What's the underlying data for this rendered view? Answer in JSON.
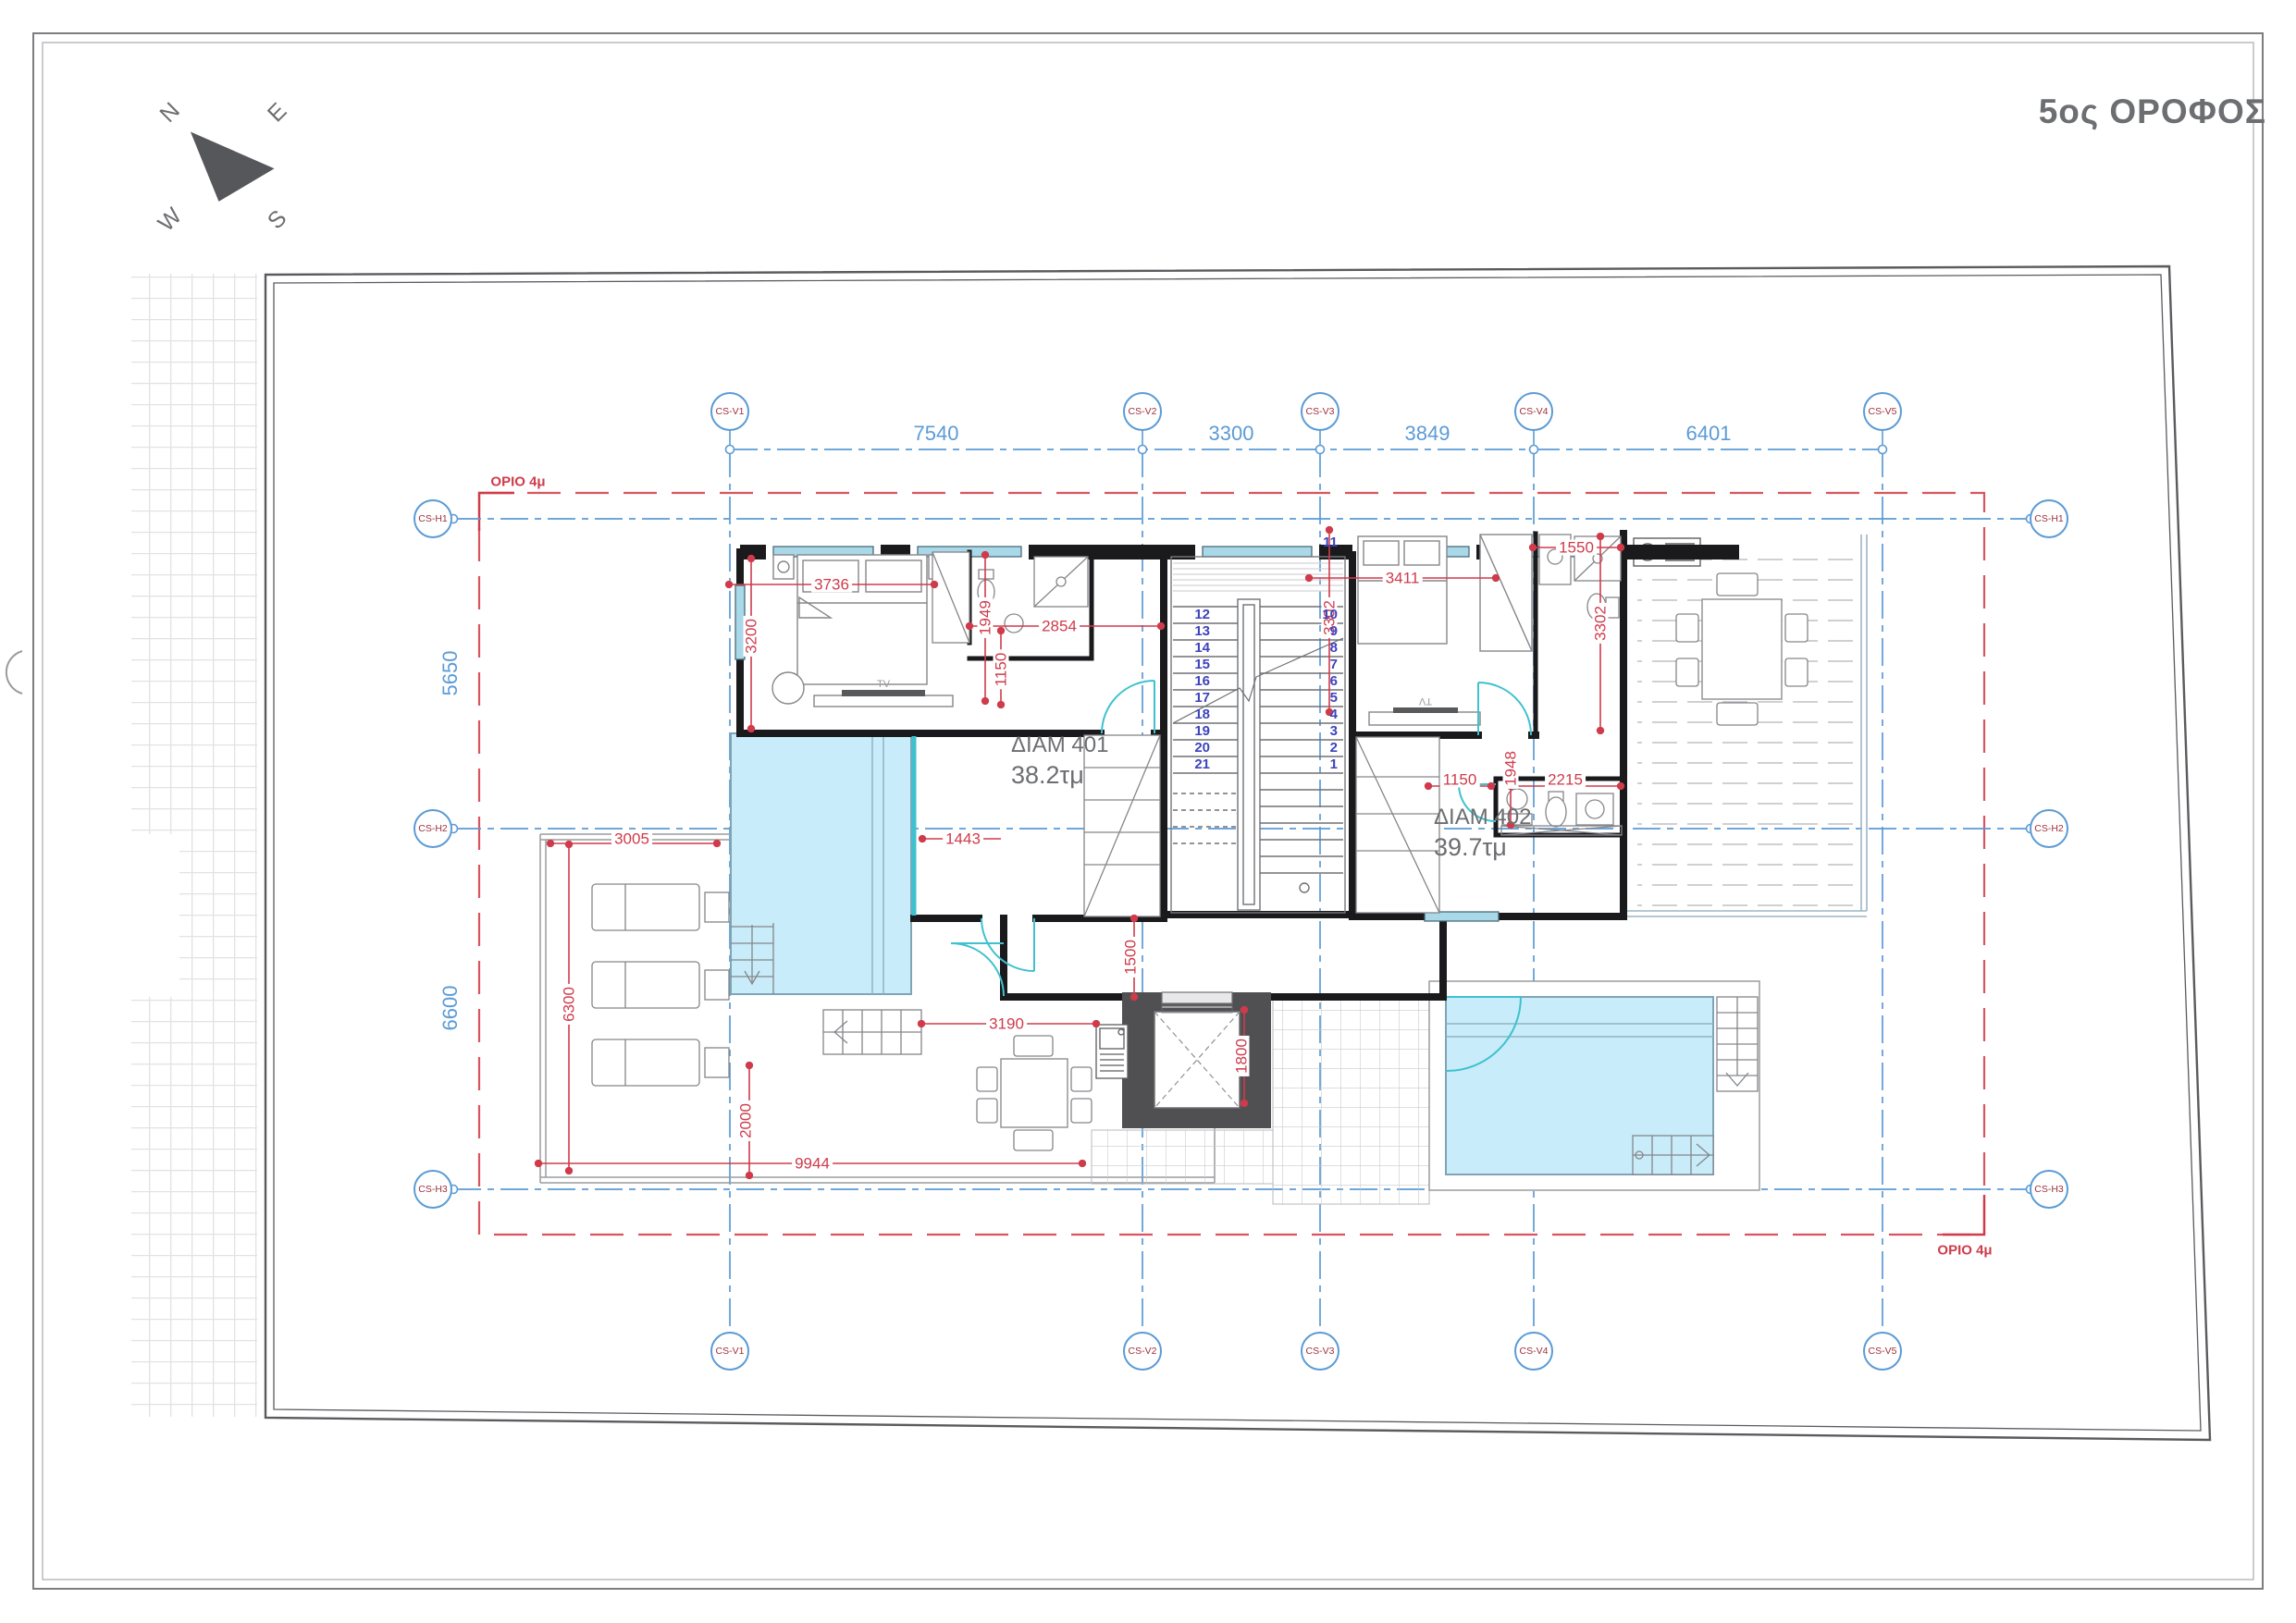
{
  "title": "5ος ΟΡΟΦΟΣ",
  "compass": {
    "n": "N",
    "e": "E",
    "s": "S",
    "w": "W"
  },
  "grid": {
    "v_labels": [
      "CS-V1",
      "CS-V2",
      "CS-V3",
      "CS-V4",
      "CS-V5"
    ],
    "h_labels": [
      "CS-H1",
      "CS-H2",
      "CS-H3"
    ],
    "v_dims": [
      "7540",
      "3300",
      "3849",
      "6401"
    ],
    "h_dims": [
      "5650",
      "6600"
    ]
  },
  "setback": {
    "top_label": "ΟΡΙΟ 4μ",
    "bottom_label": "ΟΡΙΟ 4μ"
  },
  "apartments": {
    "a401": {
      "name": "ΔΙΑΜ 401",
      "area": "38.2τμ"
    },
    "a402": {
      "name": "ΔΙΑΜ 402",
      "area": "39.7τμ"
    }
  },
  "dims": {
    "bed1_width": "3736",
    "bed1_depth": "3200",
    "bath1_depth": "1949",
    "closet1_width": "2854",
    "entry1_offset": "1150",
    "bed2_width": "3411",
    "bed2_depth": "3302",
    "bath2_width": "1550",
    "bath2_depth": "3302",
    "wc_width": "1150",
    "wc_depth": "1948",
    "wc_length": "2215",
    "terrace_width": "3005",
    "terrace_depth": "6300",
    "pool1_offset": "1443",
    "pool1_setback": "2000",
    "deck_width": "3190",
    "corridor_width": "1500",
    "elevator_depth": "1800",
    "plot_width": "9944"
  },
  "stairs": {
    "upper_flight": [
      "12",
      "13",
      "14",
      "15",
      "16",
      "17",
      "18",
      "19",
      "20",
      "21"
    ],
    "landing_step": "11",
    "lower_flight": [
      "10",
      "9",
      "8",
      "7",
      "6",
      "5",
      "4",
      "3",
      "2",
      "1"
    ]
  },
  "labels": {
    "tv1": "TV",
    "tv2": "TV"
  },
  "colors": {
    "dimension_red": "#cf3b4b",
    "grid_blue": "#5b9bd5",
    "bubble_text": "#9e3039",
    "wall_black": "#1a1a1c",
    "pool_blue": "#c8ecf9",
    "door_cyan": "#3fc1cf",
    "text_gray": "#6d6e71"
  }
}
